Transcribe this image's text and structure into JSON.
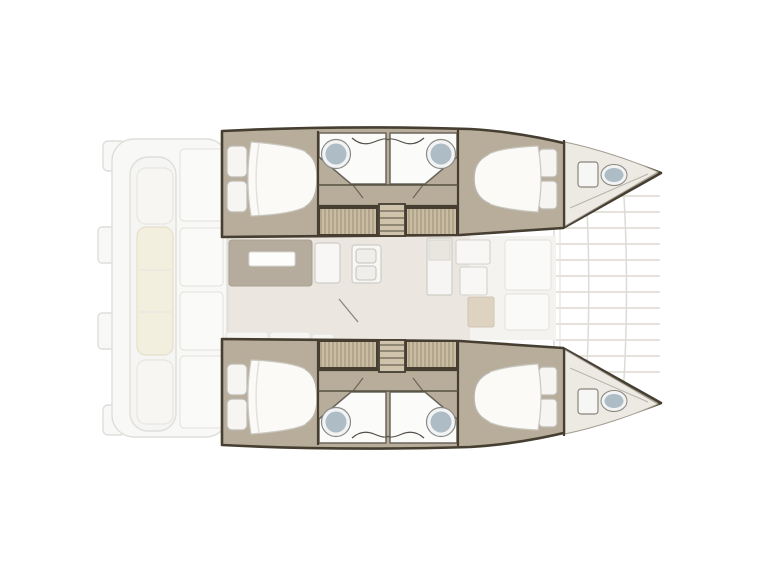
{
  "diagram": {
    "type": "yacht-floor-plan",
    "vessel": "catamaran",
    "orientation": "bow-right",
    "hulls": [
      "port",
      "starboard"
    ],
    "bridgedeck_zones": [
      "aft-cockpit",
      "salon-with-table",
      "galley",
      "forward-cockpit",
      "foredeck-trampoline"
    ],
    "per_hull_spaces": [
      "aft-double-cabin",
      "aft-head",
      "companionway-steps",
      "forward-head",
      "forward-double-cabin",
      "bow-compartment"
    ],
    "counts": {
      "double_berths": 4,
      "mid-hull_washbasins": 4,
      "bow_washbasins": 2,
      "companionway_stairs": 2
    }
  },
  "colors": {
    "background": "#ffffff",
    "hull_outline": "#453e31",
    "hull_floor": "#b8ad9a",
    "bow_floor": "#eceae3",
    "locker_hatch": "#c8bca3",
    "locker_hatch_line": "#9c8e74",
    "steps_fill": "#cfc4ab",
    "salon_floor": "#ebe7e0",
    "forward_deck_floor": "#f4f3f0",
    "table": "#b5ac9d",
    "table_tray": "#fdfdfc",
    "bathroom_floor": "#fbfbfa",
    "sink_basin": "#aebcc6",
    "sink_rim": "#f1f3f4",
    "mattress": "#fbfaf7",
    "pillow": "#f6f5f1",
    "cushion_cream": "#f3efdf",
    "exterior_fill": "#f8f8f6",
    "exterior_line": "#dfdedb",
    "furniture_white": "#f8f7f5",
    "mat_beige": "#ddd3c0"
  }
}
